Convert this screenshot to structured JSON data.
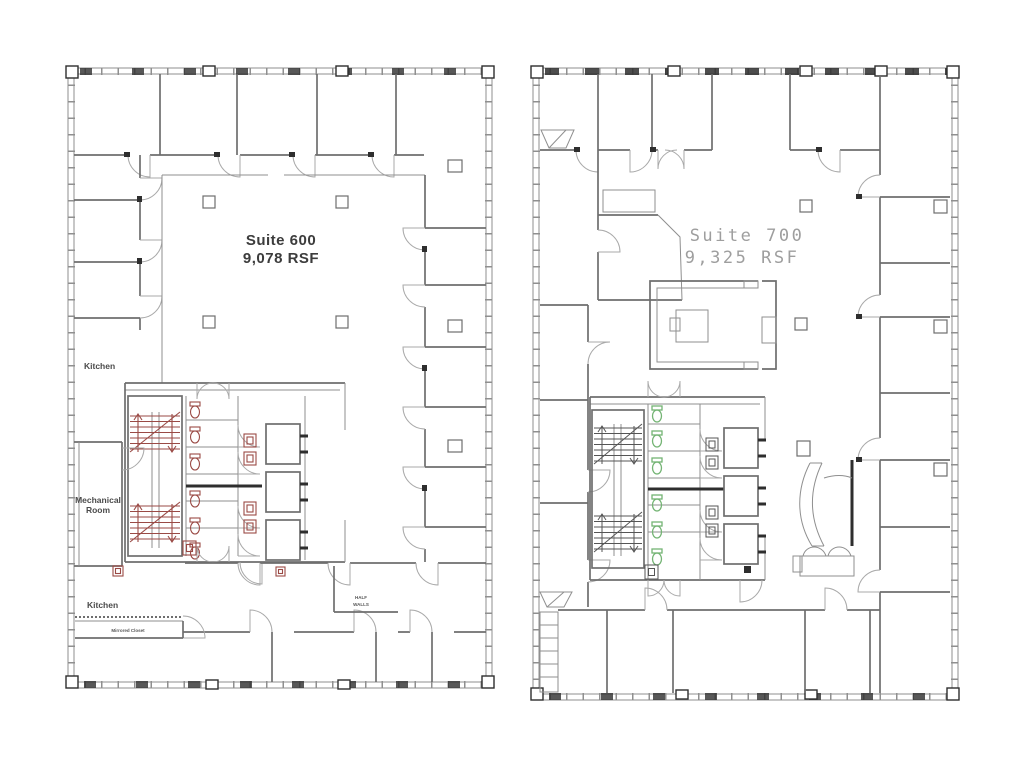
{
  "theme": {
    "wall_color": "#8f8f8f",
    "wall_strong": "#6e6e6e",
    "wall_dark": "#2e2e2e",
    "door_color": "#a9a9a9",
    "accent_red": "#9a4a45",
    "accent_green": "#74b474",
    "tread_gray": "#555555",
    "label_dark": "#3c3c3c",
    "label_gray": "#9e9e9e",
    "label_small": "#4a4a4a",
    "background": "#ffffff"
  },
  "plans": {
    "suite600": {
      "title": "Suite 600",
      "area": "9,078 RSF",
      "accent": "#9a4a45",
      "labels": {
        "kitchen_upper": "Kitchen",
        "mechanical_line1": "Mechanical",
        "mechanical_line2": "Room",
        "kitchen_lower": "Kitchen",
        "mirrored_closet": "Mirrored Closet",
        "half_walls_line1": "HALF",
        "half_walls_line2": "WALLS"
      }
    },
    "suite700": {
      "title": "Suite 700",
      "area": "9,325 RSF",
      "accent": "#74b474"
    }
  }
}
